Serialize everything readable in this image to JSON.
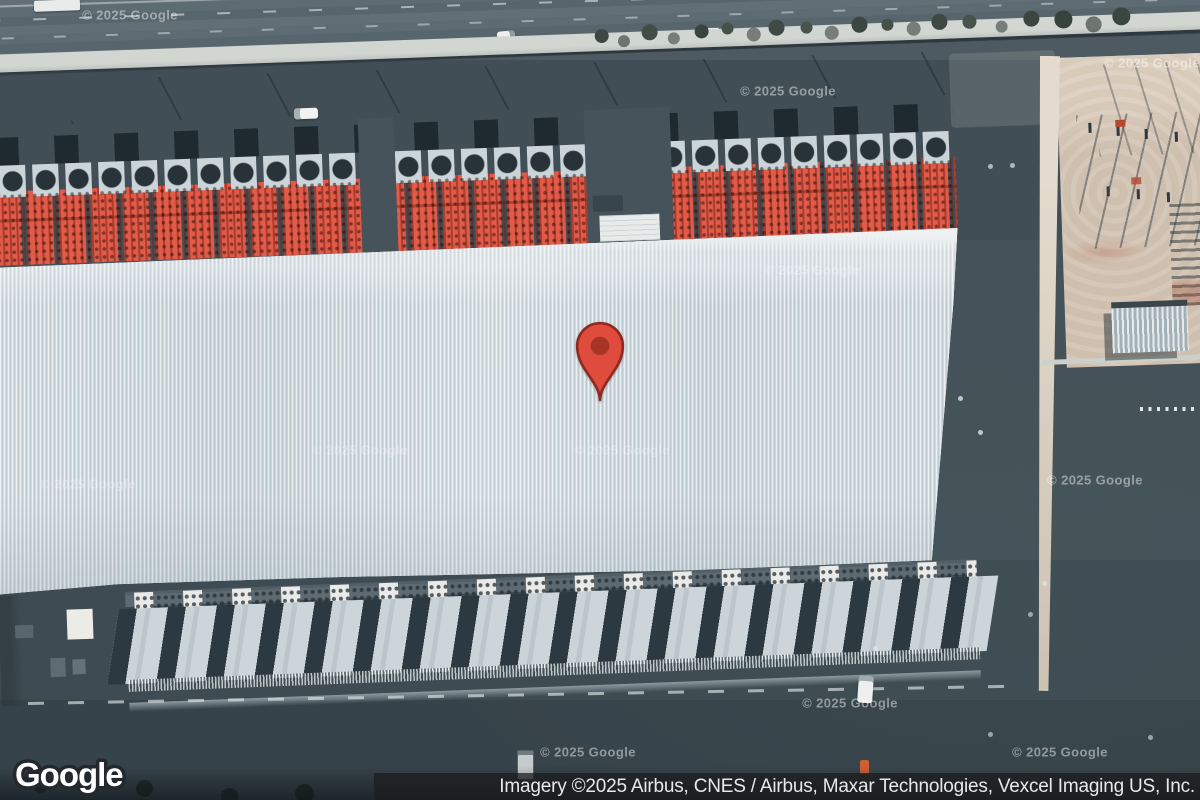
{
  "map": {
    "view_type": "satellite",
    "logo_text": "Google",
    "watermark_text": "© 2025 Google",
    "attribution_text": "Imagery ©2025 Airbus, CNES / Airbus, Maxar Technologies, Vexcel Imaging US, Inc.",
    "marker": {
      "type": "location-pin",
      "body_color": "#df4b3c",
      "outline_color": "#8e2a20",
      "dot_color": "#a83428"
    },
    "palette": {
      "asphalt": "#46535b",
      "highway": "#5b6971",
      "warehouse_roof": "#cfd9df",
      "equipment_red": "#e25b49",
      "dock_roof": "#c9d3d8",
      "dirt_lot": "#cfbfae",
      "annex_tan": "#d4cbbb",
      "sidewalk": "#d2d6d1",
      "attribution_bg": "#1c1c1c",
      "attribution_text_color": "#e8e8e8"
    }
  }
}
